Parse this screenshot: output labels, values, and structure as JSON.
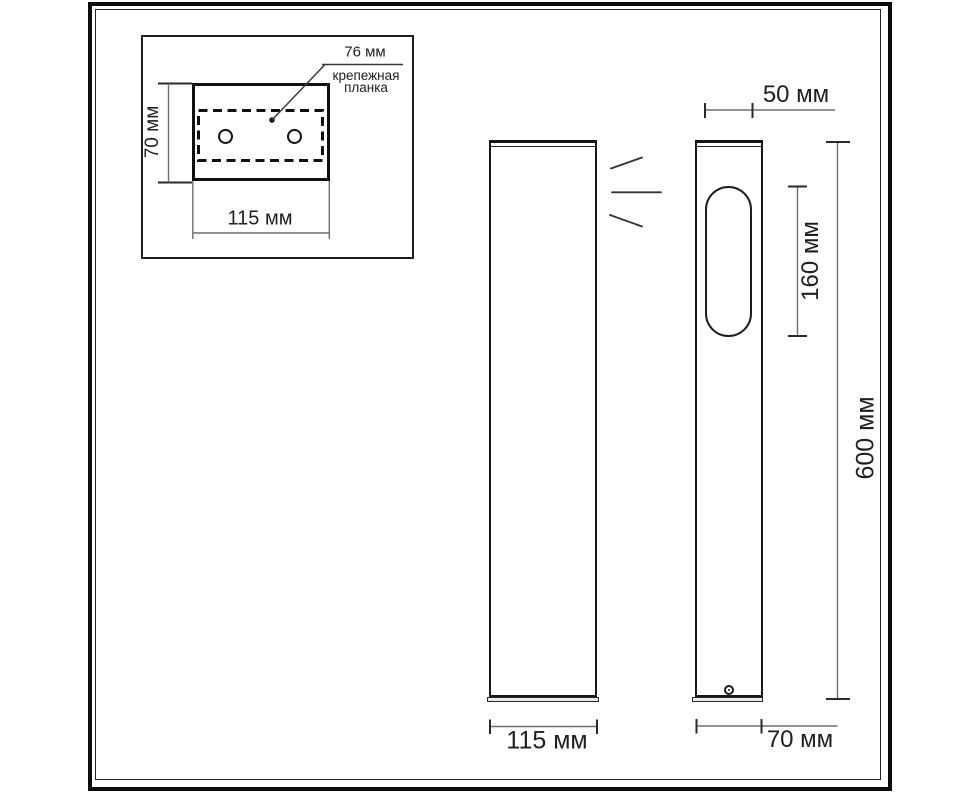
{
  "inset": {
    "plate_width_label": "76 мм",
    "plate_caption_line1": "крепежная",
    "plate_caption_line2": "планка",
    "plate_height_label": "70 мм",
    "plate_length_label": "115 мм"
  },
  "front_view": {
    "width_label": "115 мм"
  },
  "side_view": {
    "head_depth_label": "50 мм",
    "window_height_label": "160 мм",
    "total_height_label": "600 мм",
    "depth_label": "70 мм"
  },
  "colors": {
    "background": "#ffffff",
    "object_line": "#1a1a1a",
    "dimension_line": "#6e6e6e",
    "text": "#1f1f1f"
  }
}
